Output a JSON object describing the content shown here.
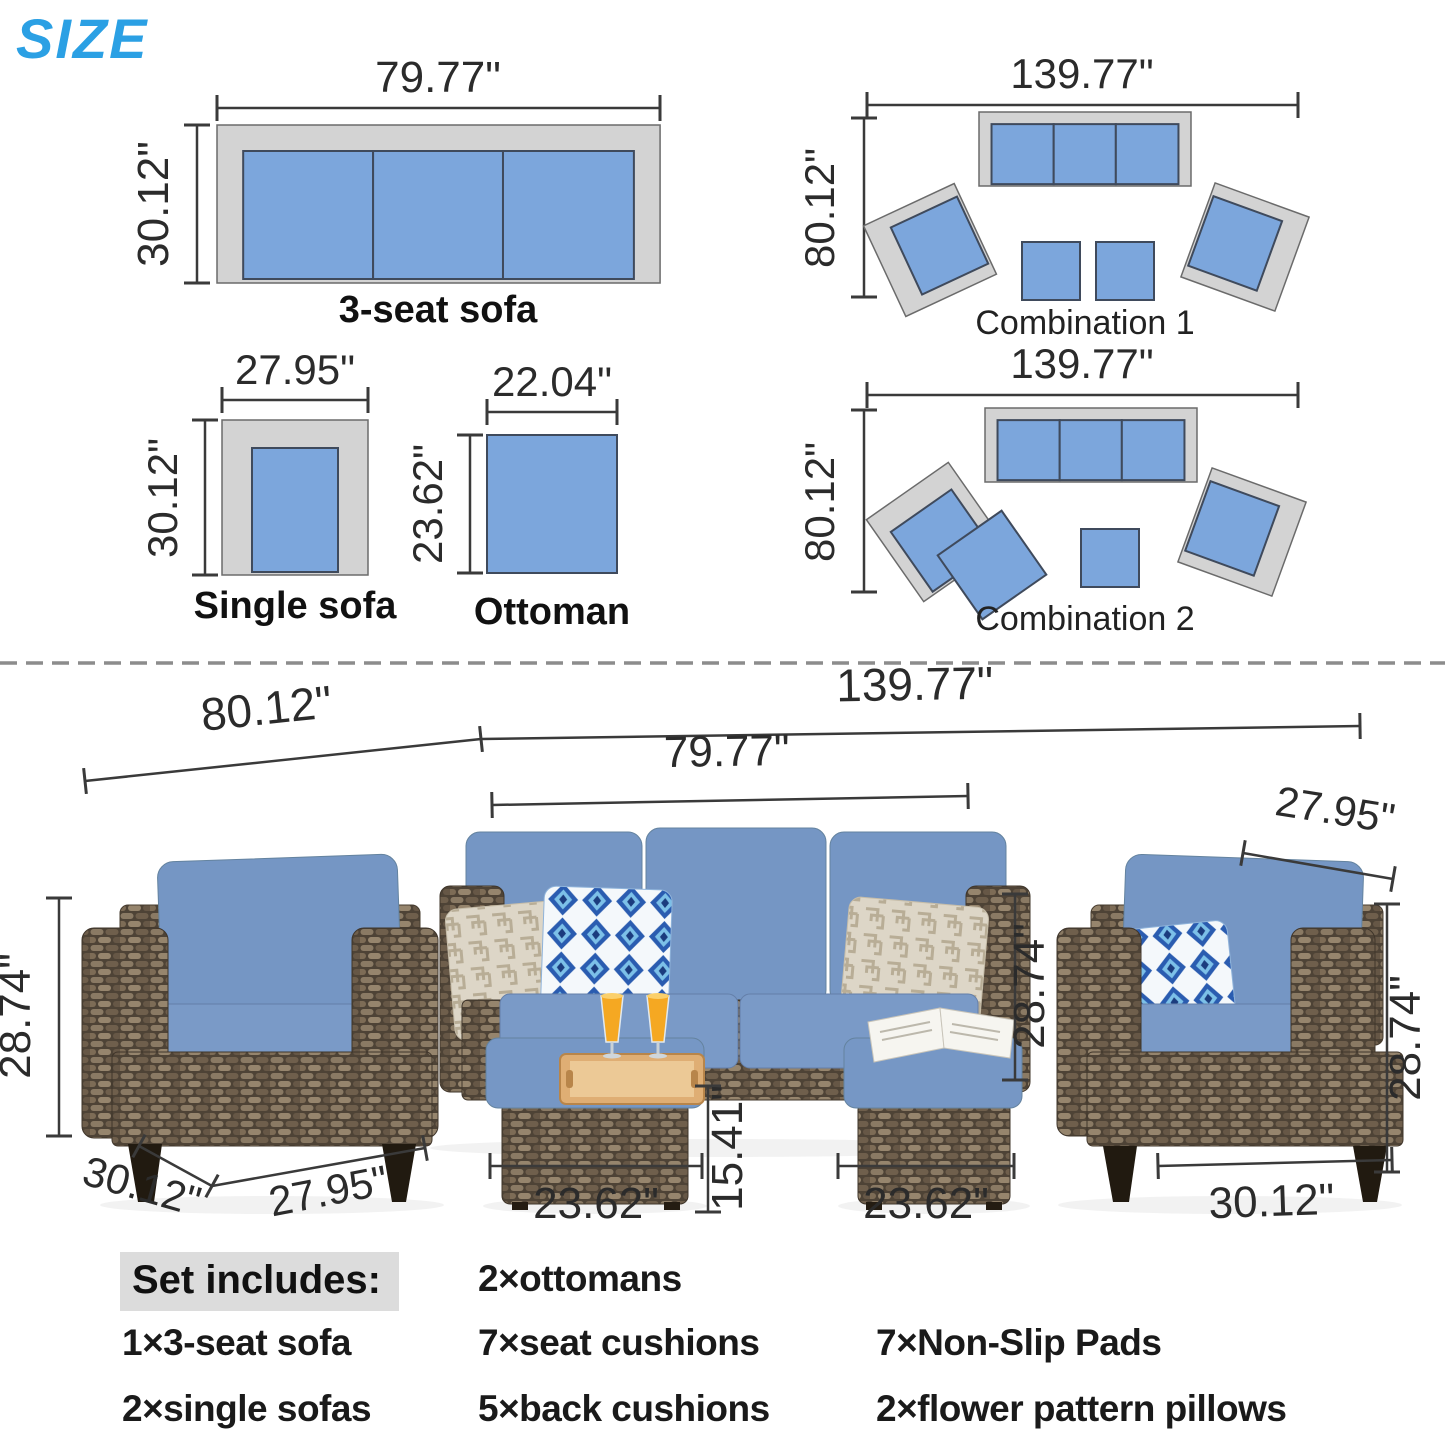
{
  "header": {
    "title": "SIZE"
  },
  "diagrams": {
    "sofa3": {
      "label": "3-seat sofa",
      "width": "79.77\"",
      "depth": "30.12\""
    },
    "single": {
      "label": "Single sofa",
      "width": "27.95\"",
      "depth": "30.12\""
    },
    "ottoman": {
      "label": "Ottoman",
      "width": "22.04\"",
      "depth": "23.62\""
    },
    "combo1": {
      "label": "Combination 1",
      "width": "139.77\"",
      "depth": "80.12\""
    },
    "combo2": {
      "label": "Combination 2",
      "width": "139.77\"",
      "depth": "80.12\""
    }
  },
  "photo_dims": {
    "group_width": "80.12\"",
    "total_width": "139.77\"",
    "sofa_width": "79.77\"",
    "right_chair_width": "27.95\"",
    "left_chair_height": "28.74\"",
    "left_chair_depth": "30.12\"",
    "left_chair_width": "27.95\"",
    "ottoman1_width": "23.62\"",
    "ottoman_height": "15.41\"",
    "ottoman2_width": "23.62\"",
    "sofa_height": "28.74\"",
    "right_chair_height": "28.74\"",
    "right_chair_depth": "30.12\""
  },
  "set_includes": {
    "heading": "Set includes:",
    "items": [
      "1×3-seat sofa",
      "2×single sofas",
      "2×ottomans",
      "7×seat cushions",
      "5×back cushions",
      "7×Non-Slip Pads",
      "2×flower pattern pillows"
    ]
  },
  "colors": {
    "accent_blue": "#2ba0e4",
    "plan_cushion_blue": "#7ca6dc",
    "plan_frame_gray": "#d3d3d3",
    "photo_cushion_blue": "#7596c4",
    "wicker_brown": "#6f5f4c",
    "dim_line": "#3a3a3a",
    "heading_highlight": "#dcdcdc"
  }
}
